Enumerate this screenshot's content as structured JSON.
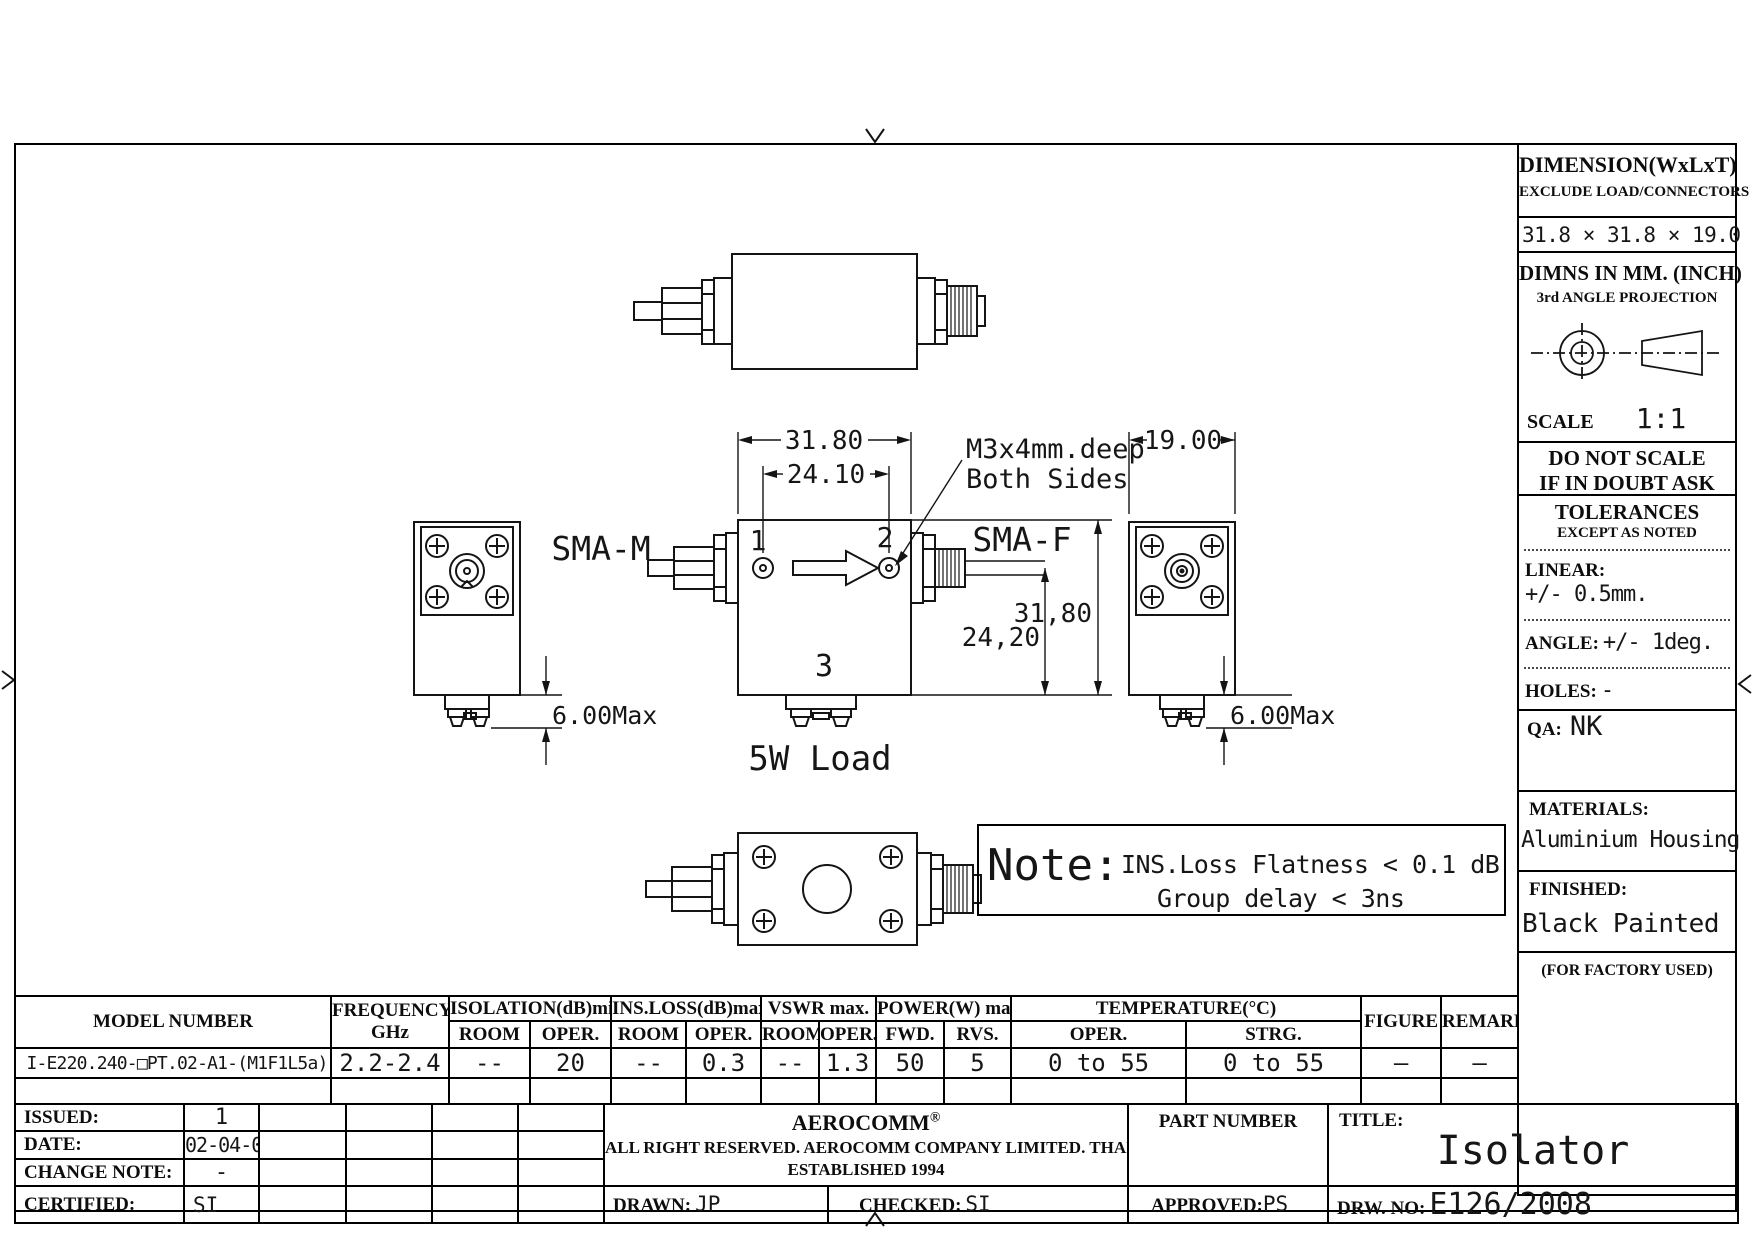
{
  "sidebar": {
    "dimension": {
      "title": "DIMENSION(WxLxT)",
      "subtitle": "EXCLUDE LOAD/CONNECTORS",
      "value": "31.8 × 31.8 × 19.0"
    },
    "projection": {
      "line1": "DIMNS IN MM. (INCH)",
      "line2": "3rd ANGLE PROJECTION",
      "scale_label": "SCALE",
      "scale_value": "1:1"
    },
    "warning": {
      "line1": "DO NOT SCALE",
      "line2": "IF IN DOUBT ASK"
    },
    "tolerances": {
      "title": "TOLERANCES",
      "subtitle": "EXCEPT AS NOTED",
      "linear_label": "LINEAR:",
      "linear_value": "+/- 0.5mm.",
      "angle_label": "ANGLE:",
      "angle_value": "+/- 1deg.",
      "holes_label": "HOLES:",
      "holes_value": "-"
    },
    "qa": {
      "label": "QA:",
      "value": "NK"
    },
    "materials": {
      "label": "MATERIALS:",
      "value": "Aluminium Housing"
    },
    "finished": {
      "label": "FINISHED:",
      "value": "Black Painted"
    },
    "factory": "(FOR FACTORY USED)"
  },
  "drawing": {
    "dims": {
      "width_top": "31.80",
      "hole_spacing": "24.10",
      "depth": "19.00",
      "height_right": "31,80",
      "port_height": "24,20",
      "tab_left": "6.00Max",
      "tab_right": "6.00Max"
    },
    "labels": {
      "sma_m": "SMA-M",
      "sma_f": "SMA-F",
      "port1": "1",
      "port2": "2",
      "port3": "3",
      "load": "5W Load",
      "callout1": "M3x4mm.deep",
      "callout2": "Both Sides"
    },
    "note": {
      "title": "Note:",
      "line1": "INS.Loss Flatness < 0.1 dB",
      "line2": "Group delay < 3ns"
    }
  },
  "spec_table": {
    "headers": {
      "model": "MODEL NUMBER",
      "frequency": "FREQUENCY",
      "frequency_unit": "GHz",
      "isolation": "ISOLATION(dB)min.",
      "ins_loss": "INS.LOSS(dB)max.",
      "vswr": "VSWR max.",
      "power": "POWER(W) max.",
      "temperature": "TEMPERATURE(°C)",
      "room": "ROOM",
      "oper": "OPER.",
      "fwd": "FWD.",
      "rvs": "RVS.",
      "strg": "STRG.",
      "figure": "FIGURE",
      "remark": "REMARK"
    },
    "row": {
      "model": "I-E220.240-□PT.02-A1-(M1F1L5a)",
      "frequency": "2.2-2.4",
      "isolation_room": "--",
      "isolation_oper": "20",
      "ins_loss_room": "--",
      "ins_loss_oper": "0.3",
      "vswr_room": "--",
      "vswr_oper": "1.3",
      "power_fwd": "50",
      "power_rvs": "5",
      "temp_oper": "0 to 55",
      "temp_strg": "0 to 55",
      "figure": "—",
      "remark": "—"
    }
  },
  "title_block": {
    "issued_label": "ISSUED:",
    "issued_value": "1",
    "date_label": "DATE:",
    "date_value": "02-04-08",
    "change_label": "CHANGE NOTE:",
    "change_value": "-",
    "certified_label": "CERTIFIED:",
    "certified_value": "SI",
    "company": {
      "name": "AEROCOMM",
      "reg": "®",
      "line2": "ALL RIGHT RESERVED. AEROCOMM COMPANY LIMITED. THAILAND",
      "line3": "ESTABLISHED 1994"
    },
    "drawn_label": "DRAWN:",
    "drawn_value": "JP",
    "checked_label": "CHECKED:",
    "checked_value": "SI",
    "approved_label": "APPROVED:",
    "approved_value": "PS",
    "part_number_label": "PART NUMBER",
    "title_label": "TITLE:",
    "title_value": "Isolator",
    "drw_label": "DRW. NO:",
    "drw_value": "E126/2008"
  }
}
